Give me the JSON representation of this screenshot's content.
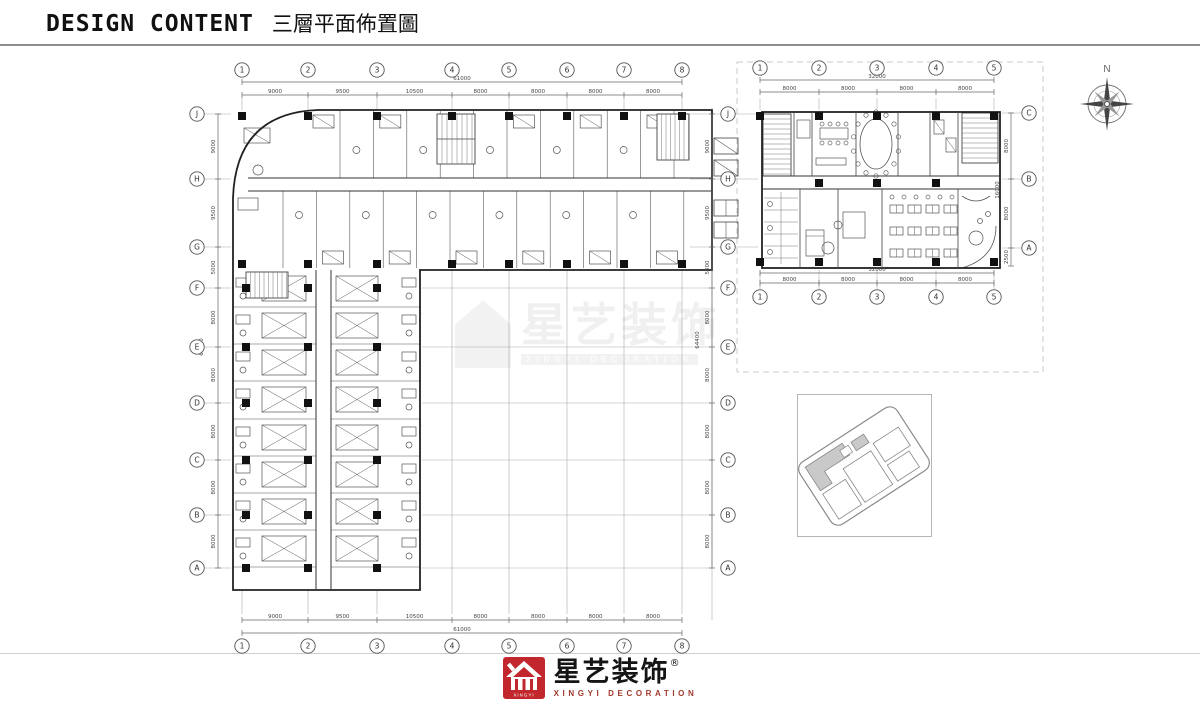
{
  "header": {
    "title_en": "DESIGN CONTENT",
    "title_zh": "三層平面佈置圖"
  },
  "compass": {
    "north": "N"
  },
  "watermark": {
    "text": "星艺装饰",
    "subtext": "XINGYI DECORATION"
  },
  "footer": {
    "brand_zh": "星艺装饰",
    "reg": "®",
    "brand_en": "XINGYI DECORATION"
  },
  "grid": {
    "left_cols": {
      "labels": [
        "1",
        "2",
        "3",
        "4",
        "5",
        "6",
        "7",
        "8"
      ],
      "dims": [
        "9000",
        "9500",
        "10500",
        "8000",
        "8000",
        "8000",
        "8000"
      ],
      "overall": "61000"
    },
    "left_rows": {
      "labels": [
        "J",
        "H",
        "G",
        "F",
        "E",
        "D",
        "C",
        "B",
        "A"
      ],
      "dims": [
        "9000",
        "9500",
        "5000",
        "8000",
        "8000",
        "8000",
        "8000",
        "8000"
      ],
      "overall": "64400"
    },
    "right_cols": {
      "labels": [
        "1",
        "2",
        "3",
        "4",
        "5"
      ],
      "dims": [
        "8000",
        "8000",
        "8000",
        "8000"
      ],
      "overall": "32000"
    },
    "right_rows": {
      "labels": [
        "C",
        "B",
        "A"
      ],
      "dims": [
        "8000",
        "8000"
      ],
      "tail": "2500",
      "overall": "16000"
    }
  },
  "colors": {
    "brand_red": "#c1272d",
    "line": "#222222",
    "dim_text": "#555555",
    "grid_light": "#aaaaaa"
  }
}
